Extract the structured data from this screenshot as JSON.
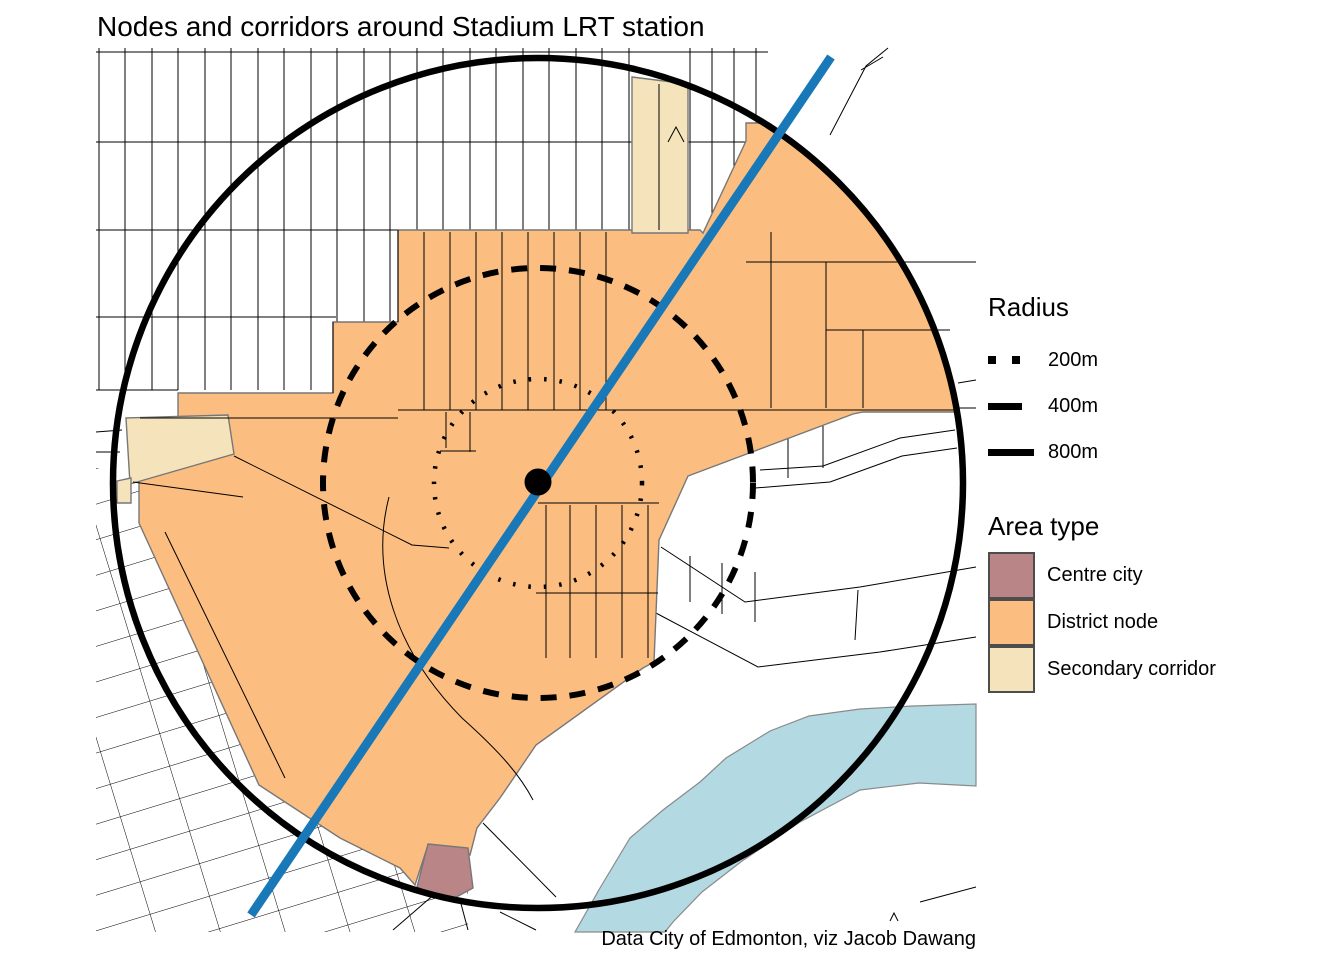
{
  "title": "Nodes and corridors around Stadium LRT station",
  "caption": "Data City of Edmonton, viz Jacob Dawang",
  "legend": {
    "radius": {
      "title": "Radius",
      "items": [
        {
          "label": "200m",
          "style": "dotted"
        },
        {
          "label": "400m",
          "style": "dashed"
        },
        {
          "label": "800m",
          "style": "solid"
        }
      ]
    },
    "area_type": {
      "title": "Area type",
      "items": [
        {
          "label": "Centre city",
          "color": "#b98587"
        },
        {
          "label": "District node",
          "color": "#fcbe80"
        },
        {
          "label": "Secondary corridor",
          "color": "#f5e4bb"
        }
      ]
    }
  },
  "map": {
    "station_label": "Stadium LRT station",
    "radii_m": [
      200,
      400,
      800
    ],
    "colors": {
      "lrt_line": "#1878b8",
      "river": "#b3d9e3",
      "river_border": "#8a8a8a",
      "streets": "#000000",
      "area_border": "#777777",
      "circles": "#000000",
      "station_dot": "#000000",
      "background": "#ffffff"
    }
  }
}
